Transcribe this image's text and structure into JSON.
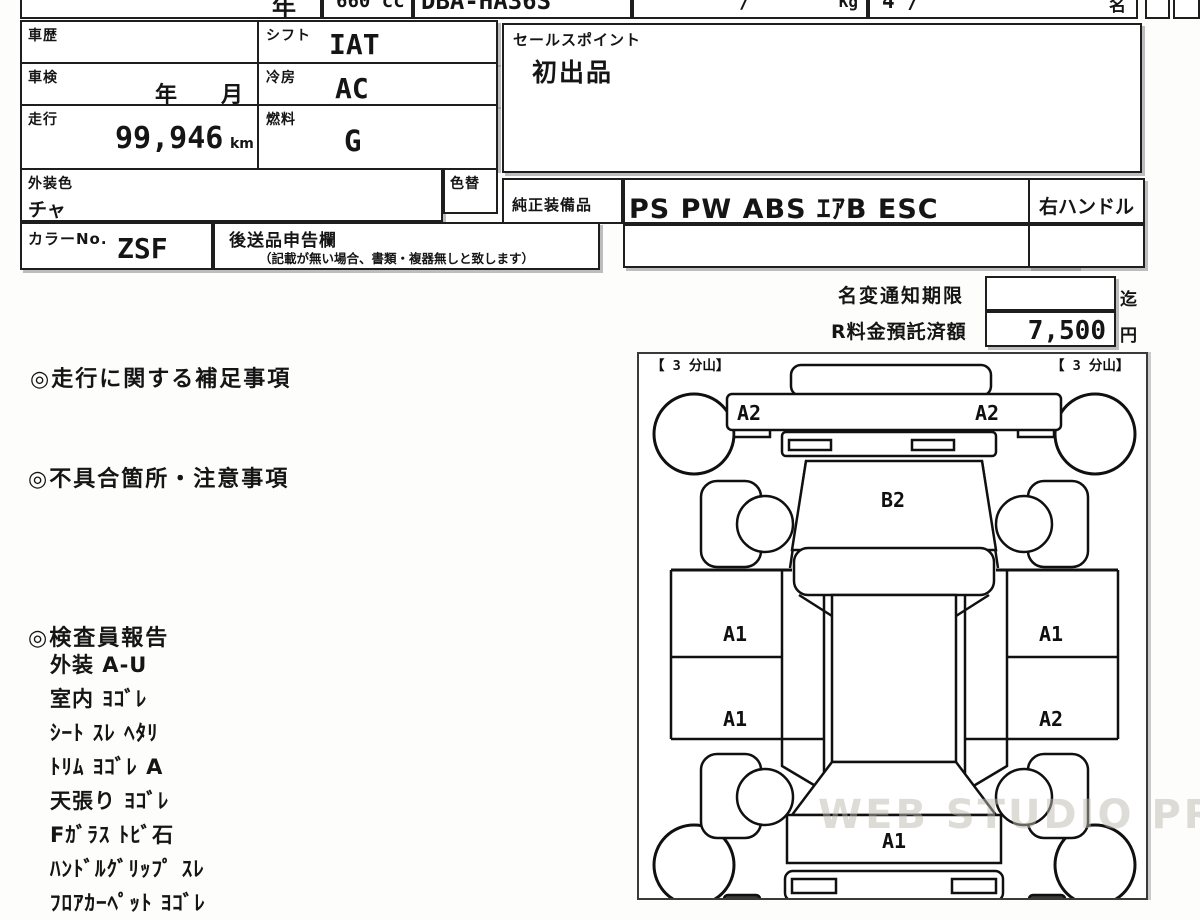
{
  "top_strip": {
    "year_fragment": "年",
    "displacement": "660 cc",
    "model_code": "DBA-HA36S",
    "weight_slash": "/",
    "weight_unit": "Kg",
    "capacity_value": "4 /",
    "capacity_unit": "名"
  },
  "vehicle": {
    "history_label": "車歴",
    "history_value": "",
    "shift_label": "シフト",
    "shift_value": "IAT",
    "inspection_label": "車検",
    "inspection_value": "年　　月",
    "aircon_label": "冷房",
    "aircon_value": "AC",
    "mileage_label": "走行",
    "mileage_value": "99,946",
    "mileage_unit": "km",
    "fuel_label": "燃料",
    "fuel_value": "G",
    "exterior_color_label": "外装色",
    "exterior_color_value": "チャ",
    "color_change_label": "色替",
    "color_no_label": "カラーNo.",
    "color_no_value": "ZSF",
    "later_items_label": "後送品申告欄",
    "later_items_note": "（記載が無い場合、書類・複器無しと致します）"
  },
  "sales_point": {
    "label": "セールスポイント",
    "value": "初出品"
  },
  "equipment": {
    "label": "純正装備品",
    "value": "PS PW  ABS ｴｱB ESC",
    "steering": "右ハンドル"
  },
  "fees": {
    "name_change_label": "名変通知期限",
    "name_change_value": "",
    "name_change_suffix": "迄",
    "recycle_label": "R料金預託済額",
    "recycle_value": "7,500",
    "recycle_suffix": "円"
  },
  "sections": {
    "mileage_notes_heading": "◎走行に関する補足事項",
    "defects_heading": "◎不具合箇所・注意事項",
    "inspector_heading": "◎検査員報告"
  },
  "inspector_report": {
    "items": [
      "外装 A-U",
      "室内 ﾖｺﾞﾚ",
      "ｼｰﾄ ｽﾚ ﾍﾀﾘ",
      "ﾄﾘﾑ ﾖｺﾞﾚ A",
      "天張り ﾖｺﾞﾚ",
      "Fｶﾞﾗｽ ﾄﾋﾞ石",
      "ﾊﾝﾄﾞﾙｸﾞﾘｯﾌﾟ ｽﾚ",
      "ﾌﾛｱｶｰﾍﾟｯﾄ ﾖｺﾞﾚ"
    ]
  },
  "diagram": {
    "tire_left": "【 3 分山】",
    "tire_right": "【 3 分山】",
    "marks": {
      "front_left": "A2",
      "front_right": "A2",
      "windshield": "B2",
      "door_fl": "A1",
      "door_fr": "A1",
      "door_rl": "A1",
      "door_rr": "A2",
      "rear_panel": "A1"
    }
  },
  "watermark": "WEB STUDIO PRO",
  "colors": {
    "line": "#1e1e1e",
    "shadow": "#7d7d7d",
    "watermark": "#beb9b0"
  }
}
